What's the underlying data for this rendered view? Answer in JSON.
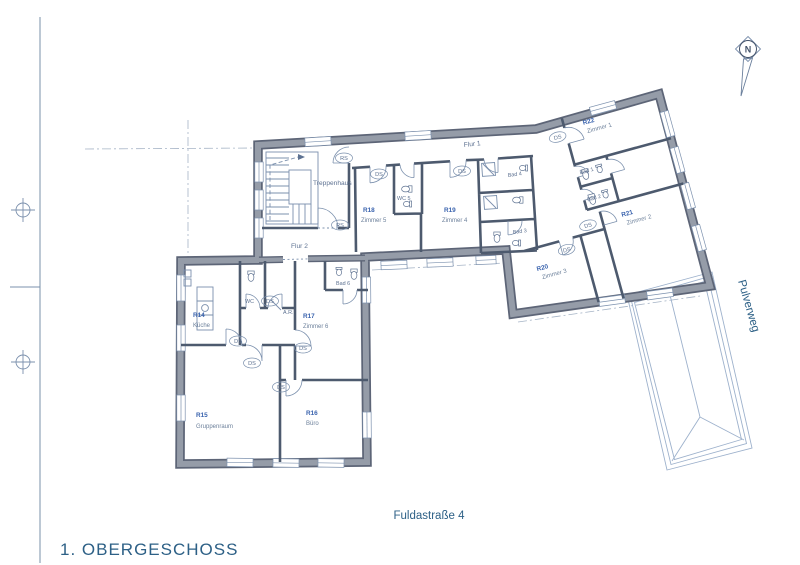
{
  "drawing": {
    "floor_title": "1. OBERGESCHOSS",
    "street_bottom": "Fuldastraße 4",
    "street_right": "Pulverweg",
    "north_letter": "N"
  },
  "rooms": [
    {
      "id": "R14",
      "name": "Küche"
    },
    {
      "id": "R15",
      "name": "Gruppenraum"
    },
    {
      "id": "R16",
      "name": "Büro"
    },
    {
      "id": "R17",
      "name": "Zimmer 6"
    },
    {
      "id": "R18",
      "name": "Zimmer 5"
    },
    {
      "id": "R19",
      "name": "Zimmer 4"
    },
    {
      "id": "R20",
      "name": "Zimmer 3"
    },
    {
      "id": "R21",
      "name": "Zimmer 2"
    },
    {
      "id": "R22",
      "name": "Zimmer 1"
    }
  ],
  "areas": {
    "stairs": "Treppenhaus",
    "hall1": "Flur 1",
    "hall2": "Flur 2",
    "bad1": "Bad 1",
    "bad2": "Bad 2",
    "bad3": "Bad 3",
    "bad4": "Bad 4",
    "bad6": "Bad 6",
    "wc": "WC",
    "wc5": "WC 5",
    "storage": "A.R."
  },
  "door_tags": {
    "ds": "DS",
    "rs": "RS"
  },
  "colors": {
    "paper": "#ffffff",
    "wall_edge": "#5d6577",
    "wall_fill": "#959ca8",
    "partition": "#4d5a6e",
    "thin": "#7b90ad",
    "room_id": "#3a63ae",
    "room_name": "#6d819b",
    "label": "#5d7191",
    "title": "#2d6086",
    "roof": "#9db1cc",
    "dash": "#a6b4c6"
  }
}
